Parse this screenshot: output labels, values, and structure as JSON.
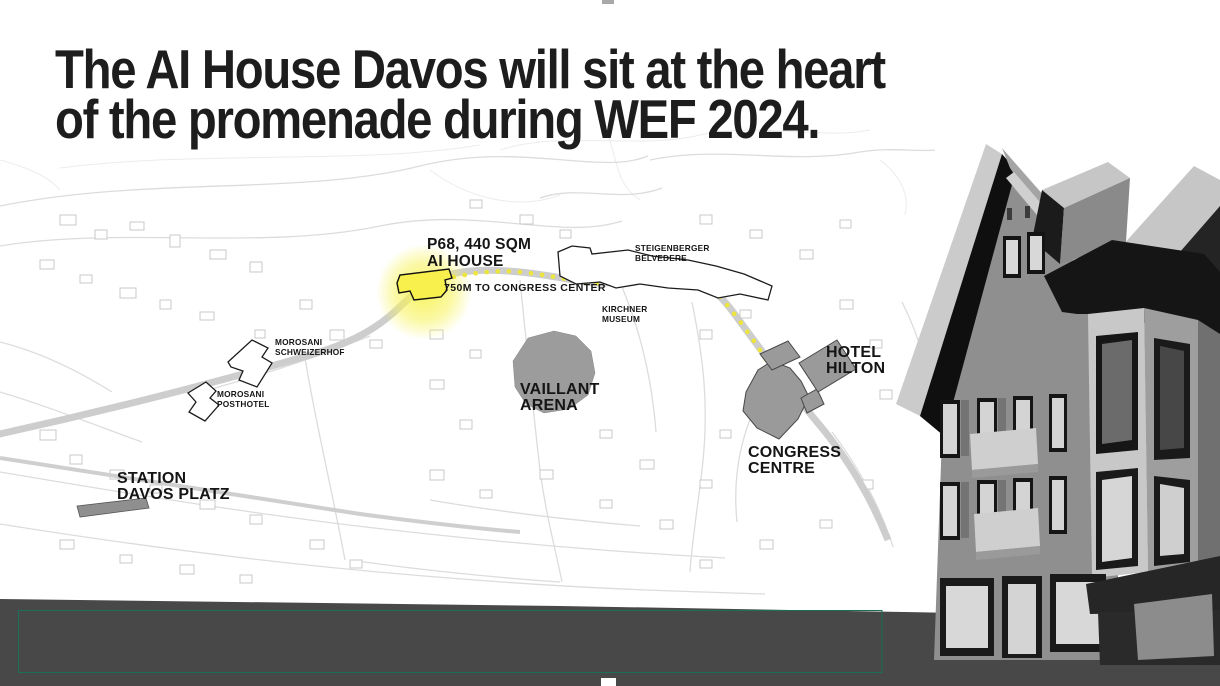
{
  "slide": {
    "title_line1": "The AI House Davos will sit at the heart",
    "title_line2": "of the promenade during WEF 2024."
  },
  "map": {
    "labels": {
      "ai_house": {
        "line1": "P68, 440 SQM",
        "line2": "AI HOUSE"
      },
      "distance": "750M TO CONGRESS CENTER",
      "steigenberger": {
        "line1": "STEIGENBERGER",
        "line2": "BELVEDERE"
      },
      "kirchner": {
        "line1": "KIRCHNER",
        "line2": "MUSEUM"
      },
      "morosani_schweizerhof": {
        "line1": "MOROSANI",
        "line2": "SCHWEIZERHOF"
      },
      "morosani_posthotel": {
        "line1": "MOROSANI",
        "line2": "POSTHOTEL"
      },
      "vaillant_arena": {
        "line1": "VAILLANT",
        "line2": "ARENA"
      },
      "hotel_hilton": {
        "line1": "HOTEL",
        "line2": "HILTON"
      },
      "congress_centre": {
        "line1": "CONGRESS",
        "line2": "CENTRE"
      },
      "station": {
        "line1": "STATION",
        "line2": "DAVOS PLATZ"
      }
    },
    "colors": {
      "highlight_yellow": "#F7F04D",
      "route_dot_yellow": "#EDE53C",
      "landmark_grey": "#9A9A9A",
      "street_grey": "#DCDCDC"
    }
  },
  "footer": {
    "panel_color": "#484848",
    "placeholder_outline_color": "#1B6E57"
  }
}
